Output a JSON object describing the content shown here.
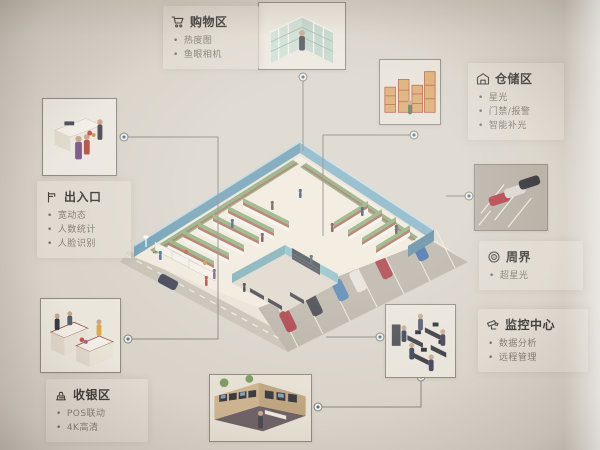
{
  "diagram_title": "",
  "panels": [
    {
      "id": "shopping",
      "title": "购物区",
      "icon": "cart-icon",
      "bullets": [
        "热度图",
        "鱼眼相机"
      ]
    },
    {
      "id": "storage",
      "title": "仓储区",
      "icon": "warehouse-icon",
      "bullets": [
        "星光",
        "门禁/报警",
        "智能补光"
      ]
    },
    {
      "id": "entrance",
      "title": "出入口",
      "icon": "gate-icon",
      "bullets": [
        "宽动态",
        "人数统计",
        "人脸识别"
      ]
    },
    {
      "id": "perimeter",
      "title": "周界",
      "icon": "radar-icon",
      "bullets": [
        "超星光"
      ]
    },
    {
      "id": "monitoring",
      "title": "监控中心",
      "icon": "cctv-icon",
      "bullets": [
        "数据分析",
        "远程管理"
      ]
    },
    {
      "id": "cashier",
      "title": "收银区",
      "icon": "register-icon",
      "bullets": [
        "POS联动",
        "4K高清"
      ]
    }
  ],
  "thumbnails": [
    {
      "name": "shopping-shelves-photo"
    },
    {
      "name": "warehouse-racks-photo"
    },
    {
      "name": "entrance-people-photo"
    },
    {
      "name": "parking-cars-photo"
    },
    {
      "name": "monitoring-office-photo"
    },
    {
      "name": "video-wall-room-photo"
    },
    {
      "name": "checkout-counters-photo"
    }
  ],
  "colors": {
    "background": "#d9d3c9",
    "wall_blue": "#6d9cb3",
    "wall_blue_light": "#85b2c5",
    "wall_teal": "#7aacb6",
    "floor": "#f0e9dc",
    "asphalt": "#b9b1a5",
    "road": "#c6bfb3",
    "shelf_green": "#8fae7a",
    "shelf_red": "#aa6f5c",
    "car_blue": "#3f6ca5",
    "car_red": "#a93a43",
    "car_dark": "#3a3a42",
    "connector_line": "#8b887f",
    "node_dot": "#4a6f96",
    "text_title": "#403e39",
    "text_bullet": "#827e73"
  }
}
